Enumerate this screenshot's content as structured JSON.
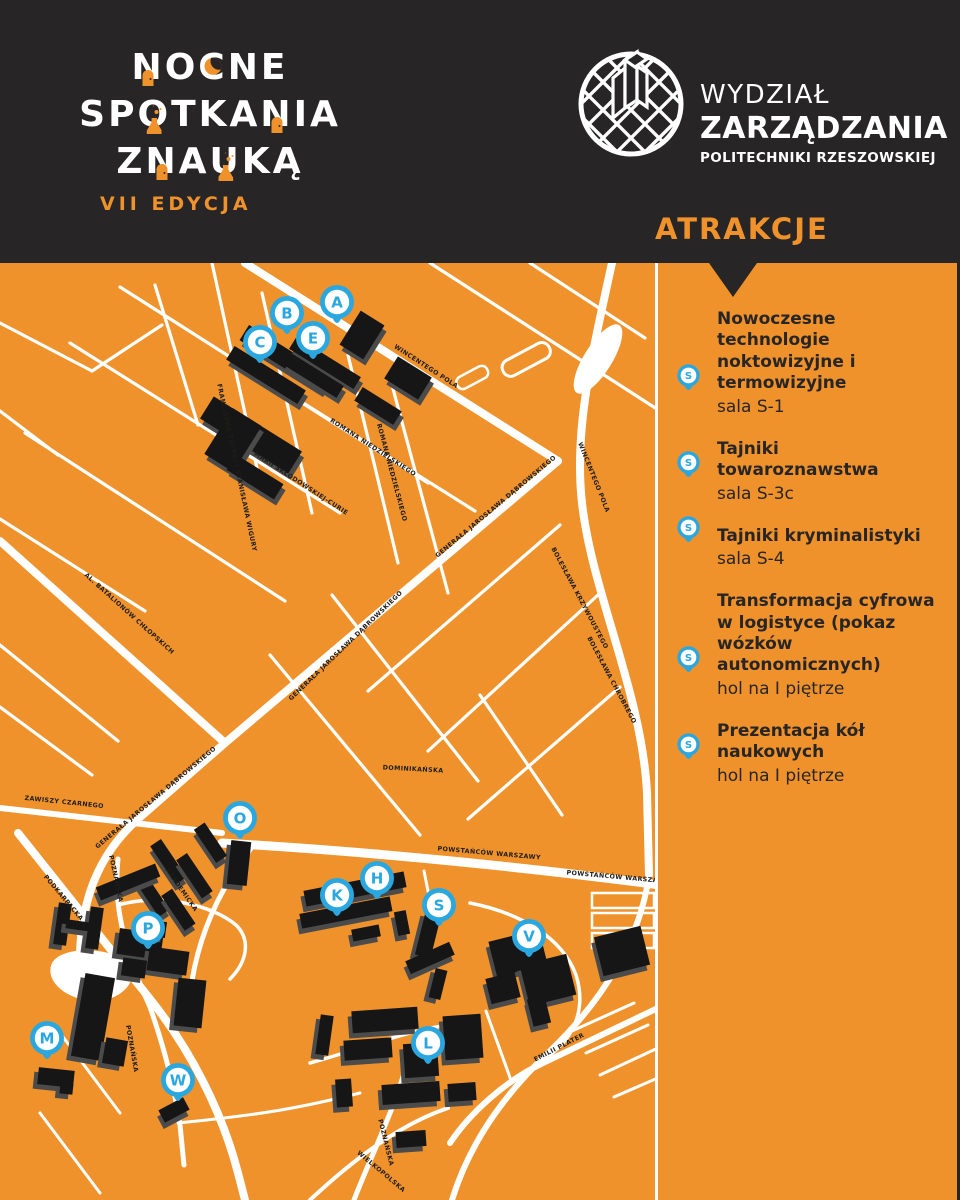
{
  "header": {
    "title_lines": [
      "NOCNE",
      "SPOTKANIA",
      "Z NAUKĄ"
    ],
    "title_decorations": [
      {
        "line": 0,
        "char": 0,
        "type": "door"
      },
      {
        "line": 0,
        "char": 2,
        "type": "moon"
      },
      {
        "line": 1,
        "char": 2,
        "type": "flask"
      },
      {
        "line": 1,
        "char": 6,
        "type": "door"
      },
      {
        "line": 2,
        "char": 2,
        "type": "door"
      },
      {
        "line": 2,
        "char": 4,
        "type": "flask"
      }
    ],
    "edition": "VII EDYCJA",
    "faculty": {
      "line1": "WYDZIAŁ",
      "line2": "ZARZĄDZANIA",
      "line3": "POLITECHNIKI RZESZOWSKIEJ"
    }
  },
  "sidebar": {
    "heading": "ATRAKCJE",
    "attractions": [
      {
        "title": "Nowoczesne technologie noktowizyjne i termowizyjne",
        "location": "sala S-1",
        "pin": "S"
      },
      {
        "title": "Tajniki towaroznawstwa",
        "location": "sala S-3c",
        "pin": "S"
      },
      {
        "title": "Tajniki kryminalistyki",
        "location": "sala S-4",
        "pin": "S"
      },
      {
        "title": "Transformacja cyfrowa w logistyce (pokaz wózków autonomicznych)",
        "location": "hol na I piętrze",
        "pin": "S"
      },
      {
        "title": "Prezentacja kół naukowych",
        "location": "hol na I piętrze",
        "pin": "S"
      }
    ]
  },
  "map": {
    "markers": [
      {
        "letter": "A",
        "x": 337,
        "y": 39
      },
      {
        "letter": "B",
        "x": 287,
        "y": 50
      },
      {
        "letter": "C",
        "x": 260,
        "y": 79
      },
      {
        "letter": "E",
        "x": 313,
        "y": 75
      },
      {
        "letter": "O",
        "x": 240,
        "y": 555
      },
      {
        "letter": "K",
        "x": 337,
        "y": 632
      },
      {
        "letter": "H",
        "x": 377,
        "y": 615
      },
      {
        "letter": "S",
        "x": 439,
        "y": 642
      },
      {
        "letter": "V",
        "x": 529,
        "y": 673
      },
      {
        "letter": "P",
        "x": 148,
        "y": 665
      },
      {
        "letter": "M",
        "x": 47,
        "y": 775
      },
      {
        "letter": "W",
        "x": 178,
        "y": 817
      },
      {
        "letter": "L",
        "x": 428,
        "y": 780
      }
    ],
    "street_labels": [
      {
        "text": "WINCENTEGO POLA",
        "x": 425,
        "y": 105,
        "rot": 33
      },
      {
        "text": "WINCENTEGO POLA",
        "x": 592,
        "y": 215,
        "rot": 68
      },
      {
        "text": "ROMANA NIEDZIELSKIEGO",
        "x": 372,
        "y": 186,
        "rot": 33
      },
      {
        "text": "ROMANA NIEDZIELSKIEGO",
        "x": 390,
        "y": 210,
        "rot": 75
      },
      {
        "text": "FRANCISZKA ŻWIRKI I STANISŁAWA WIGURY",
        "x": 235,
        "y": 205,
        "rot": 78
      },
      {
        "text": "MARII SKŁODOWSKIEJ-CURIE",
        "x": 300,
        "y": 222,
        "rot": 33
      },
      {
        "text": "GENERAŁA JAROSŁAWA DĄBROWSKIEGO",
        "x": 497,
        "y": 245,
        "rot": -40
      },
      {
        "text": "GENERAŁA JAROSŁAWA DĄBROWSKIEGO",
        "x": 347,
        "y": 384,
        "rot": -44
      },
      {
        "text": "GENERAŁA JAROSŁAWA DĄBROWSKIEGO",
        "x": 157,
        "y": 536,
        "rot": -40
      },
      {
        "text": "ZAWISZY CZARNEGO",
        "x": 64,
        "y": 541,
        "rot": 6
      },
      {
        "text": "AL. BATALIONÓW CHŁOPSKICH",
        "x": 128,
        "y": 352,
        "rot": 42
      },
      {
        "text": "BOLESŁAWA KRZYWOUSTEGO",
        "x": 578,
        "y": 336,
        "rot": 62
      },
      {
        "text": "BOLESŁAWA CHROBREGO",
        "x": 610,
        "y": 418,
        "rot": 62
      },
      {
        "text": "DOMINIKAŃSKA",
        "x": 413,
        "y": 508,
        "rot": 3
      },
      {
        "text": "POWSTAŃCÓW WARSZAWY",
        "x": 489,
        "y": 592,
        "rot": 5
      },
      {
        "text": "POWSTAŃCÓW WARSZAWY",
        "x": 618,
        "y": 616,
        "rot": 5
      },
      {
        "text": "PODKARPACKA",
        "x": 62,
        "y": 636,
        "rot": 50
      },
      {
        "text": "POZNAŃSKA",
        "x": 114,
        "y": 616,
        "rot": 78
      },
      {
        "text": "AKADEMICKA",
        "x": 180,
        "y": 628,
        "rot": 55
      },
      {
        "text": "POZNAŃSKA",
        "x": 130,
        "y": 786,
        "rot": 80
      },
      {
        "text": "POZNAŃSKA",
        "x": 384,
        "y": 880,
        "rot": 76
      },
      {
        "text": "WIELKOPOLSKA",
        "x": 380,
        "y": 910,
        "rot": 40
      },
      {
        "text": "EMILII PLATER",
        "x": 560,
        "y": 786,
        "rot": -27
      }
    ]
  },
  "colors": {
    "orange": "#F0922B",
    "dark": "#272525",
    "blue": "#2BA7E0",
    "white": "#FFFFFF",
    "building_black": "#161616",
    "building_shadow": "#4B4B4B"
  }
}
